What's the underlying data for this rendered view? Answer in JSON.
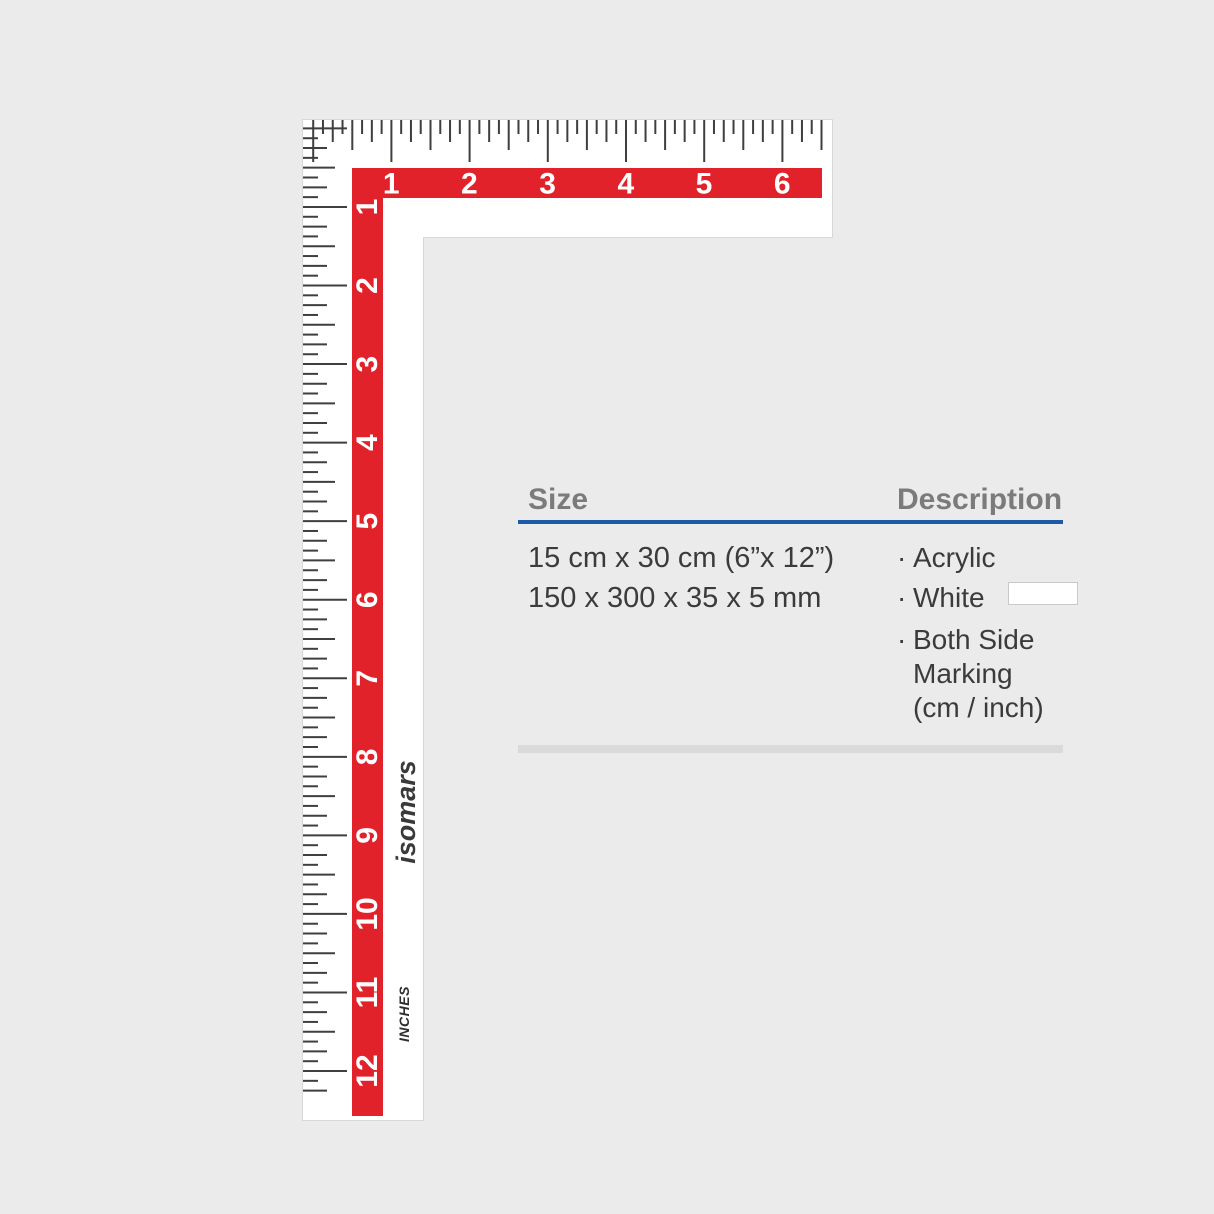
{
  "ruler": {
    "brand": "isomars",
    "unit_label": "INCHES",
    "horizontal_scale": {
      "unit": "inch",
      "numbers": [
        "1",
        "2",
        "3",
        "4",
        "5",
        "6"
      ]
    },
    "vertical_scale": {
      "unit": "inch",
      "numbers": [
        "1",
        "2",
        "3",
        "4",
        "5",
        "6",
        "7",
        "8",
        "9",
        "10",
        "11",
        "12"
      ]
    },
    "colors": {
      "red": "#e1222a",
      "tick": "#3f3f3f",
      "body": "#ffffff",
      "number_text": "#ffffff",
      "brand_text": "#3a3a3a"
    }
  },
  "spec": {
    "size": {
      "header": "Size",
      "lines": [
        "15 cm x 30 cm (6”x 12”)",
        "150 x 300 x 35 x 5 mm"
      ]
    },
    "description": {
      "header": "Description",
      "items": [
        {
          "bullet": "·",
          "lines": [
            "Acrylic"
          ]
        },
        {
          "bullet": "·",
          "lines": [
            "White"
          ],
          "swatch_color": "#ffffff"
        },
        {
          "bullet": "·",
          "lines": [
            "Both Side",
            "Marking",
            "(cm / inch)"
          ]
        }
      ]
    },
    "accent_blue": "#1d5ba6"
  }
}
